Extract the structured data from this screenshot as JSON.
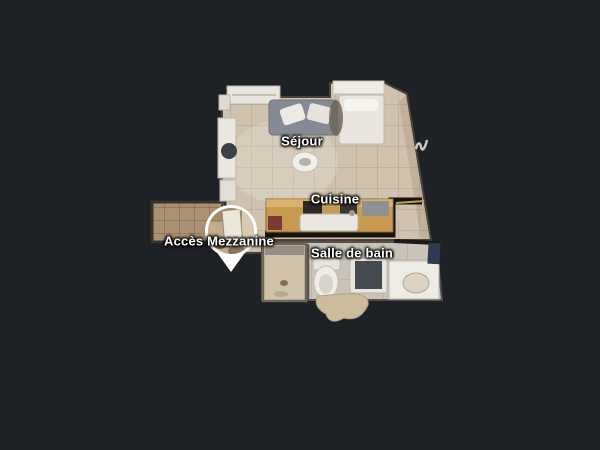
{
  "app": {
    "view": "floorplan",
    "background": "#1e2126"
  },
  "floorplan": {
    "labels": [
      {
        "id": "sejour",
        "text": "Séjour"
      },
      {
        "id": "cuisine",
        "text": "Cuisine"
      },
      {
        "id": "acces-mezzanine",
        "text": "Accès Mezzanine"
      },
      {
        "id": "salle-de-bain",
        "text": "Salle de bain"
      }
    ],
    "pin": {
      "room": "Accès Mezzanine",
      "type": "navigation-pin"
    },
    "colors": {
      "background": "#1e2126",
      "floor_main": "#cfc2ae",
      "floor_mezzanine": "#aa9173",
      "floor_bathroom": "#cac3b9",
      "wall_dark": "#15120f",
      "kitchen_counter": "#c79a52",
      "sofa": "#868a95",
      "fixture_white": "#eceae4",
      "label_text": "#ffffff",
      "pin_ring": "#ffffff"
    }
  }
}
